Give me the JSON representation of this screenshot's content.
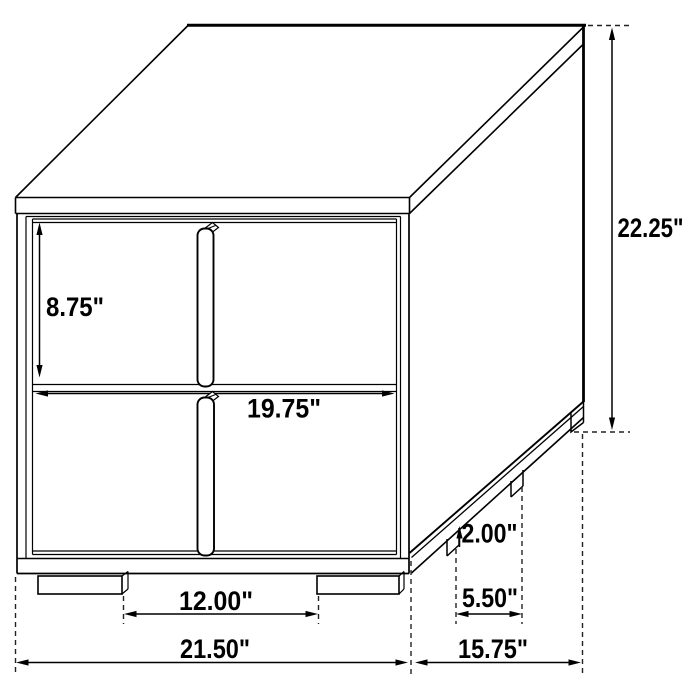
{
  "figure": {
    "subject": "Line drawing of a two-drawer nightstand with dimension annotations",
    "background_color": "#ffffff",
    "line_color": "#000000",
    "units": "inches",
    "dims": {
      "drawer_height": "8.75\"",
      "drawer_width": "19.75\"",
      "overall_height": "22.25\"",
      "foot_height": "2.00\"",
      "side_foot_spacing": "5.50\"",
      "front_foot_spacing": "12.00\"",
      "overall_width": "21.50\"",
      "overall_depth": "15.75\""
    }
  }
}
